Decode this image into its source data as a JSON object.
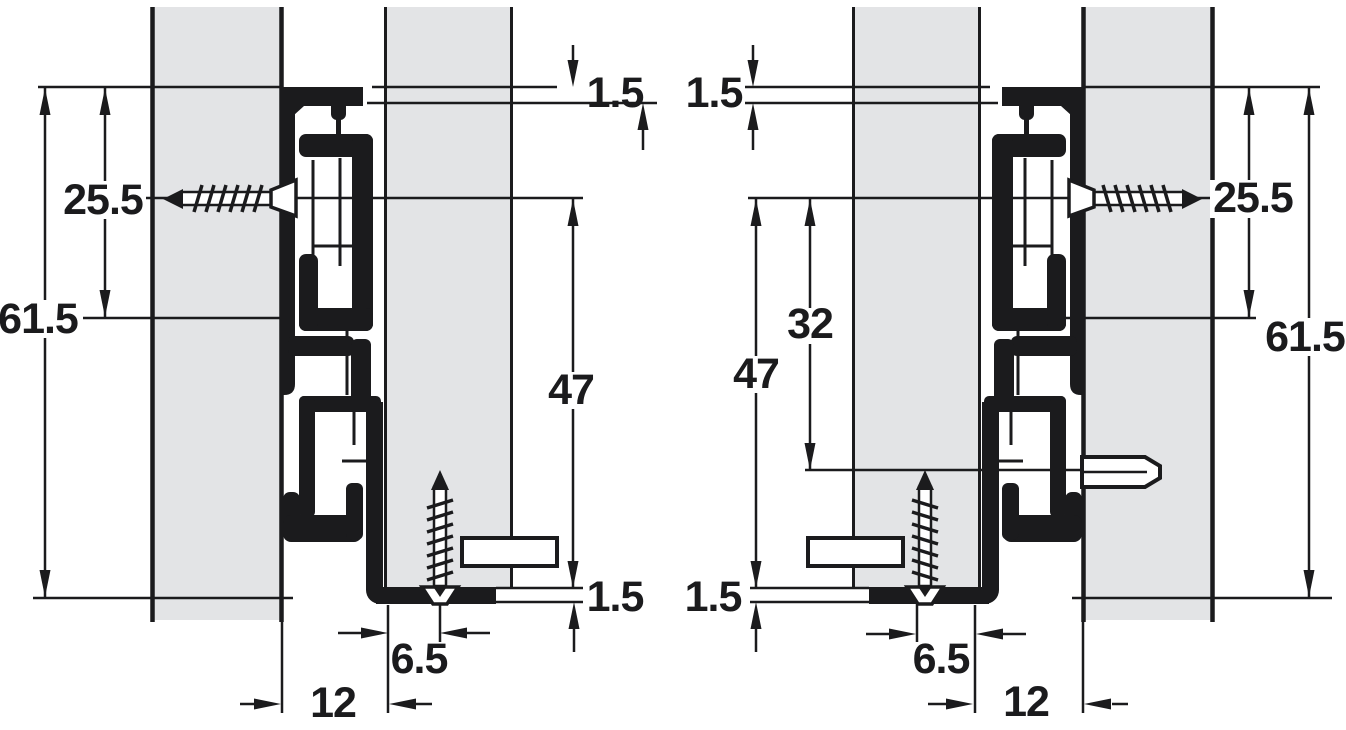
{
  "colors": {
    "ink": "#1b1b1d",
    "panel_fill": "#e3e4e6",
    "background": "#ffffff"
  },
  "left_view": {
    "overall_height": "61.5",
    "top_to_screw_axis": "25.5",
    "top_clearance": "1.5",
    "screw_axis_to_bottom": "47",
    "bottom_thickness": "1.5",
    "screw_to_front_edge": "6.5",
    "runner_front_offset": "12"
  },
  "right_view": {
    "top_clearance": "1.5",
    "screw_axis_to_bottom": "47",
    "screw_axis_to_pin": "32",
    "top_to_screw_axis": "25.5",
    "overall_height": "61.5",
    "bottom_thickness": "1.5",
    "screw_to_front_edge": "6.5",
    "runner_front_offset": "12"
  }
}
